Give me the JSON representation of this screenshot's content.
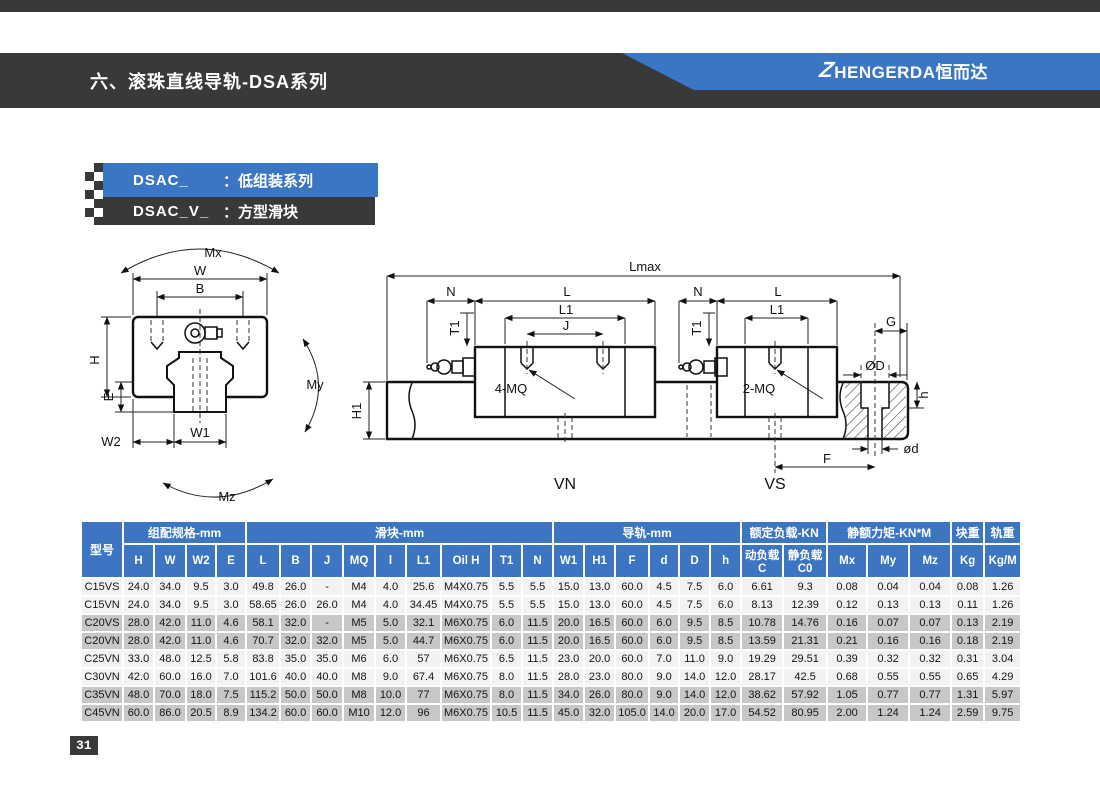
{
  "page": {
    "badge": "31"
  },
  "header": {
    "title": "六、滚珠直线导轨-DSA系列",
    "logo_z": "Z",
    "logo_text": "HENGERDA恒而达",
    "brand_blue": "#3b76c4",
    "band_dark": "#39383a"
  },
  "series_labels": {
    "primary_code": "DSAC_",
    "primary_desc": "：低组装系列",
    "secondary_code": "DSAC_V_",
    "secondary_desc": "：方型滑块"
  },
  "diagram": {
    "labels": {
      "mx": "Mx",
      "my": "My",
      "mz": "Mz",
      "w": "W",
      "b": "B",
      "h": "H",
      "e": "E",
      "w2": "W2",
      "w1": "W1",
      "lmax": "Lmax",
      "n": "N",
      "l": "L",
      "l1": "L1",
      "j": "J",
      "t1": "T1",
      "four_mq": "4-MQ",
      "two_mq": "2-MQ",
      "g": "G",
      "phiD": "ØD",
      "hole_h": "h",
      "phid": "ød",
      "f": "F",
      "h1": "H1",
      "vn": "VN",
      "vs": "VS"
    }
  },
  "table": {
    "col_model": "型号",
    "groups": [
      {
        "label": "组配规格-mm",
        "span": 4
      },
      {
        "label": "滑块-mm",
        "span": 9
      },
      {
        "label": "导轨-mm",
        "span": 6
      },
      {
        "label": "额定负载-KN",
        "span": 2
      },
      {
        "label": "静额力矩-KN*M",
        "span": 3
      },
      {
        "label": "块重",
        "span": 1
      },
      {
        "label": "轨重",
        "span": 1
      }
    ],
    "subheaders": [
      "H",
      "W",
      "W2",
      "E",
      "L",
      "B",
      "J",
      "MQ",
      "l",
      "L1",
      "Oil H",
      "T1",
      "N",
      "W1",
      "H1",
      "F",
      "d",
      "D",
      "h",
      "动负载C",
      "静负载C0",
      "Mx",
      "My",
      "Mz",
      "Kg",
      "Kg/M"
    ],
    "rows": [
      {
        "model": "C15VS",
        "shade": "light",
        "values": [
          "24.0",
          "34.0",
          "9.5",
          "3.0",
          "49.8",
          "26.0",
          "-",
          "M4",
          "4.0",
          "25.6",
          "M4X0.75",
          "5.5",
          "5.5",
          "15.0",
          "13.0",
          "60.0",
          "4.5",
          "7.5",
          "6.0",
          "6.61",
          "9.3",
          "0.08",
          "0.04",
          "0.04",
          "0.08",
          "1.26"
        ]
      },
      {
        "model": "C15VN",
        "shade": "light",
        "values": [
          "24.0",
          "34.0",
          "9.5",
          "3.0",
          "58.65",
          "26.0",
          "26.0",
          "M4",
          "4.0",
          "34.45",
          "M4X0.75",
          "5.5",
          "5.5",
          "15.0",
          "13.0",
          "60.0",
          "4.5",
          "7.5",
          "6.0",
          "8.13",
          "12.39",
          "0.12",
          "0.13",
          "0.13",
          "0.11",
          "1.26"
        ]
      },
      {
        "model": "C20VS",
        "shade": "dark",
        "values": [
          "28.0",
          "42.0",
          "11.0",
          "4.6",
          "58.1",
          "32.0",
          "-",
          "M5",
          "5.0",
          "32.1",
          "M6X0.75",
          "6.0",
          "11.5",
          "20.0",
          "16.5",
          "60.0",
          "6.0",
          "9.5",
          "8.5",
          "10.78",
          "14.76",
          "0.16",
          "0.07",
          "0.07",
          "0.13",
          "2.19"
        ]
      },
      {
        "model": "C20VN",
        "shade": "dark",
        "values": [
          "28.0",
          "42.0",
          "11.0",
          "4.6",
          "70.7",
          "32.0",
          "32.0",
          "M5",
          "5.0",
          "44.7",
          "M6X0.75",
          "6.0",
          "11.5",
          "20.0",
          "16.5",
          "60.0",
          "6.0",
          "9.5",
          "8.5",
          "13.59",
          "21.31",
          "0.21",
          "0.16",
          "0.16",
          "0.18",
          "2.19"
        ]
      },
      {
        "model": "C25VN",
        "shade": "light",
        "values": [
          "33.0",
          "48.0",
          "12.5",
          "5.8",
          "83.8",
          "35.0",
          "35.0",
          "M6",
          "6.0",
          "57",
          "M6X0.75",
          "6.5",
          "11.5",
          "23.0",
          "20.0",
          "60.0",
          "7.0",
          "11.0",
          "9.0",
          "19.29",
          "29.51",
          "0.39",
          "0.32",
          "0.32",
          "0.31",
          "3.04"
        ]
      },
      {
        "model": "C30VN",
        "shade": "light",
        "values": [
          "42.0",
          "60.0",
          "16.0",
          "7.0",
          "101.6",
          "40.0",
          "40.0",
          "M8",
          "9.0",
          "67.4",
          "M6X0.75",
          "8.0",
          "11.5",
          "28.0",
          "23.0",
          "80.0",
          "9.0",
          "14.0",
          "12.0",
          "28.17",
          "42.5",
          "0.68",
          "0.55",
          "0.55",
          "0.65",
          "4.29"
        ]
      },
      {
        "model": "C35VN",
        "shade": "dark",
        "values": [
          "48.0",
          "70.0",
          "18.0",
          "7.5",
          "115.2",
          "50.0",
          "50.0",
          "M8",
          "10.0",
          "77",
          "M6X0.75",
          "8.0",
          "11.5",
          "34.0",
          "26.0",
          "80.0",
          "9.0",
          "14.0",
          "12.0",
          "38.62",
          "57.92",
          "1.05",
          "0.77",
          "0.77",
          "1.31",
          "5.97"
        ]
      },
      {
        "model": "C45VN",
        "shade": "dark",
        "values": [
          "60.0",
          "86.0",
          "20.5",
          "8.9",
          "134.2",
          "60.0",
          "60.0",
          "M10",
          "12.0",
          "96",
          "M6X0.75",
          "10.5",
          "11.5",
          "45.0",
          "32.0",
          "105.0",
          "14.0",
          "20.0",
          "17.0",
          "54.52",
          "80.95",
          "2.00",
          "1.24",
          "1.24",
          "2.59",
          "9.75"
        ]
      }
    ]
  }
}
